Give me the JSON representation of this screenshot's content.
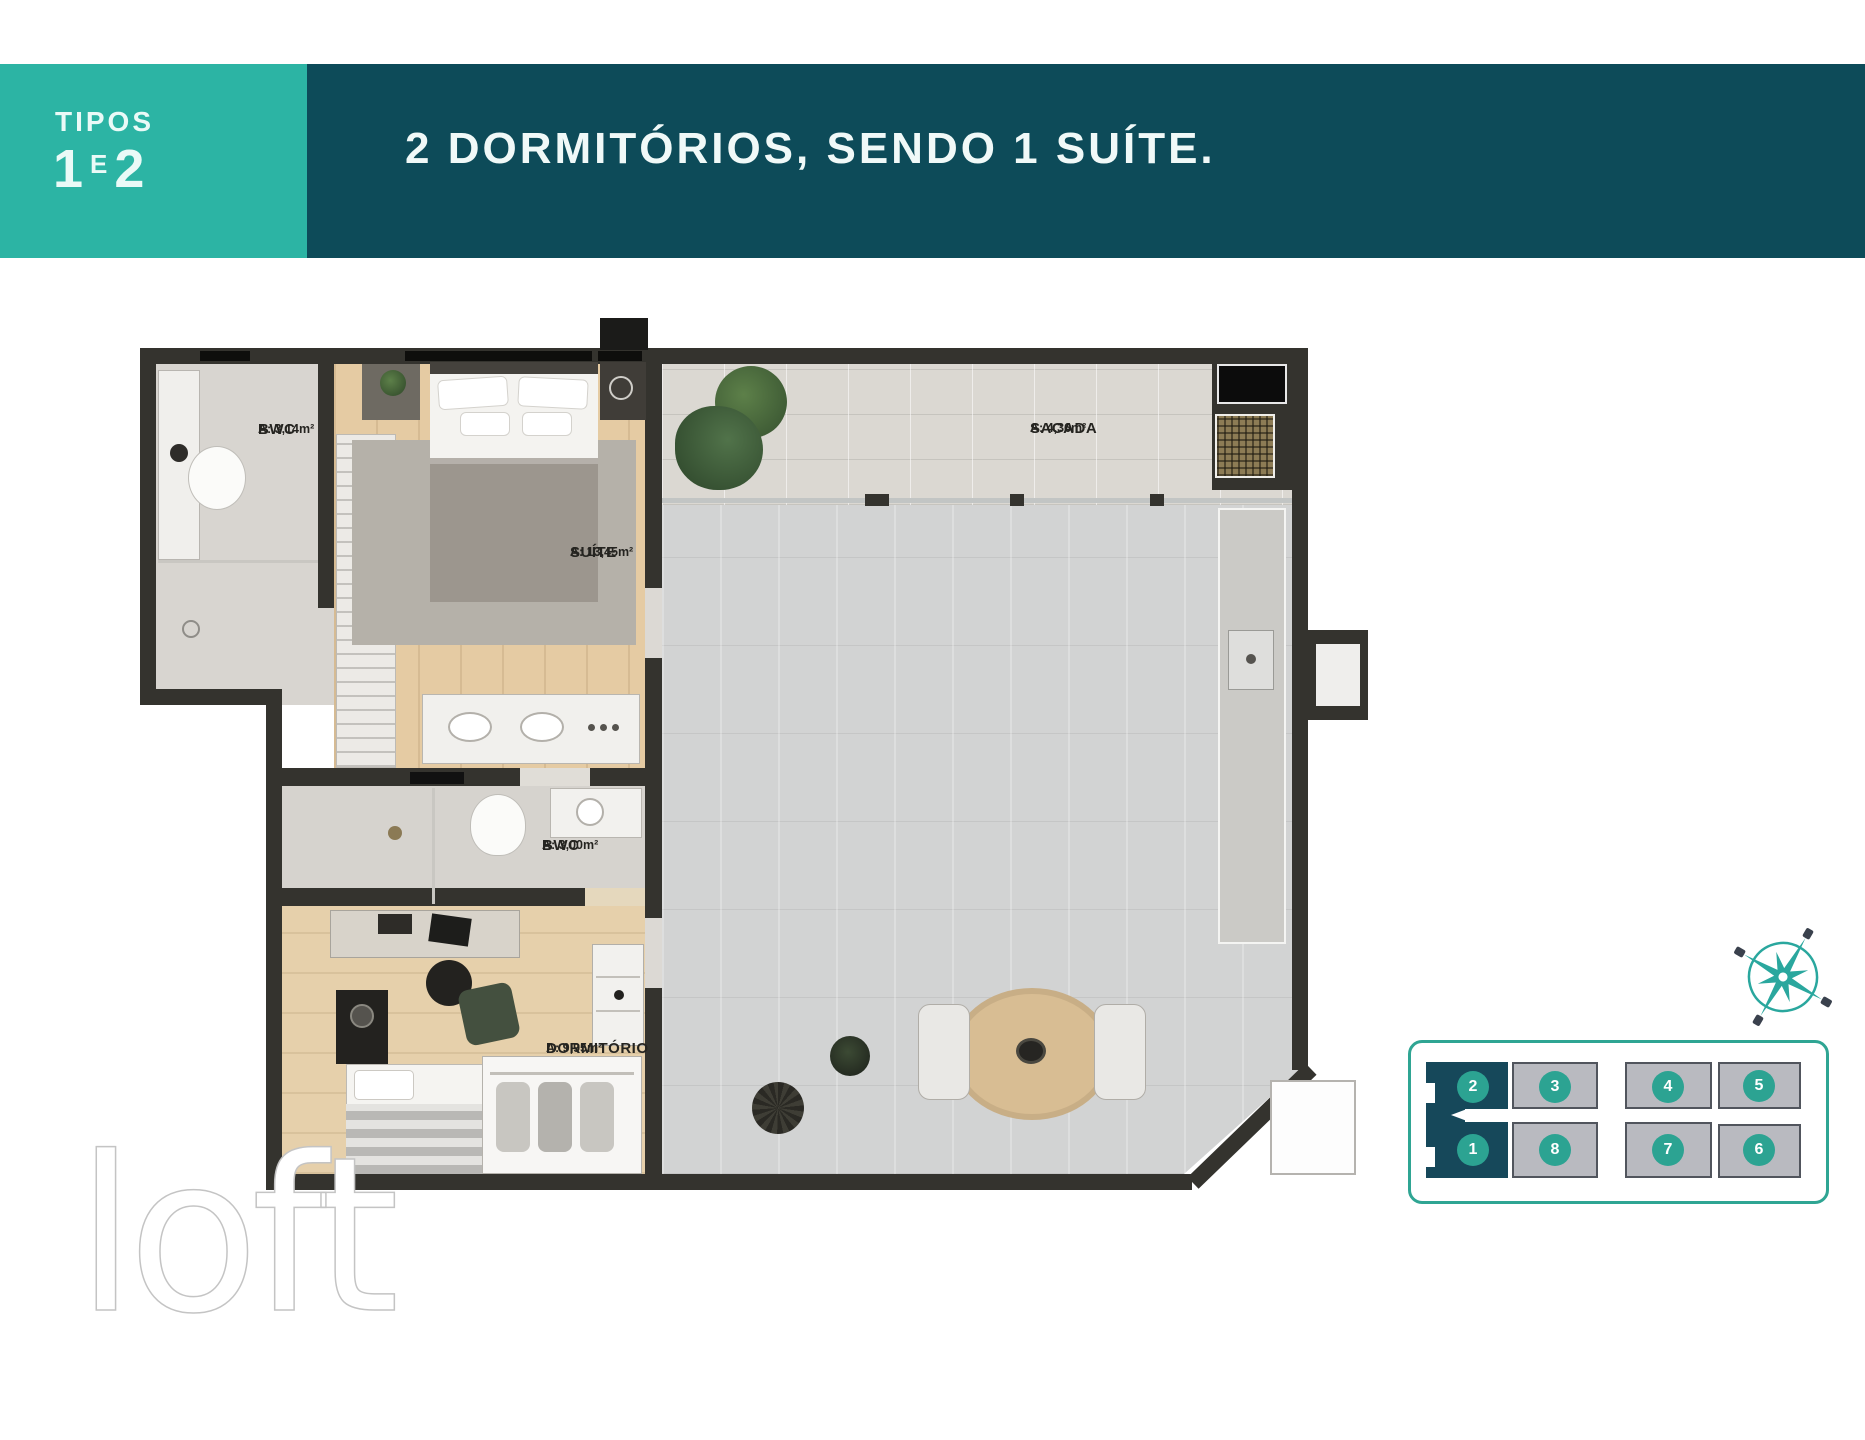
{
  "header": {
    "type_label": {
      "line1": "TIPOS",
      "num1": "1",
      "conj": "E",
      "num2": "2"
    },
    "title": "2 DORMITÓRIOS, SENDO 1 SUÍTE.",
    "colors": {
      "tag_bg": "#2cb4a4",
      "banner_bg": "#0d4b59",
      "text": "#f0f9f8"
    }
  },
  "floor_plan": {
    "rooms": [
      {
        "id": "bwc-suite",
        "name": "BWC",
        "area": "A: 3,14m²"
      },
      {
        "id": "suite",
        "name": "SUÍTE",
        "area": "A: 13,45m²"
      },
      {
        "id": "sacada",
        "name": "SACADA",
        "area": "A: 4,36m²"
      },
      {
        "id": "bwc-social",
        "name": "BWC",
        "area": "A: 3,00m²"
      },
      {
        "id": "dormitorio",
        "name": "DORMITÓRIO",
        "area": "A: 9,95m²"
      }
    ],
    "wall_color": "#34332e"
  },
  "key_plan": {
    "units": [
      {
        "number": "2",
        "highlighted": true
      },
      {
        "number": "3",
        "highlighted": false
      },
      {
        "number": "4",
        "highlighted": false
      },
      {
        "number": "5",
        "highlighted": false
      },
      {
        "number": "1",
        "highlighted": true
      },
      {
        "number": "8",
        "highlighted": false
      },
      {
        "number": "7",
        "highlighted": false
      },
      {
        "number": "6",
        "highlighted": false
      }
    ],
    "highlight_color": "#16485a",
    "unit_color": "#b9bac0",
    "circle_color": "#2ca392",
    "border_color": "#2fa593"
  },
  "compass": {
    "color": "#2aa79e"
  },
  "watermark": {
    "text": "loft"
  }
}
